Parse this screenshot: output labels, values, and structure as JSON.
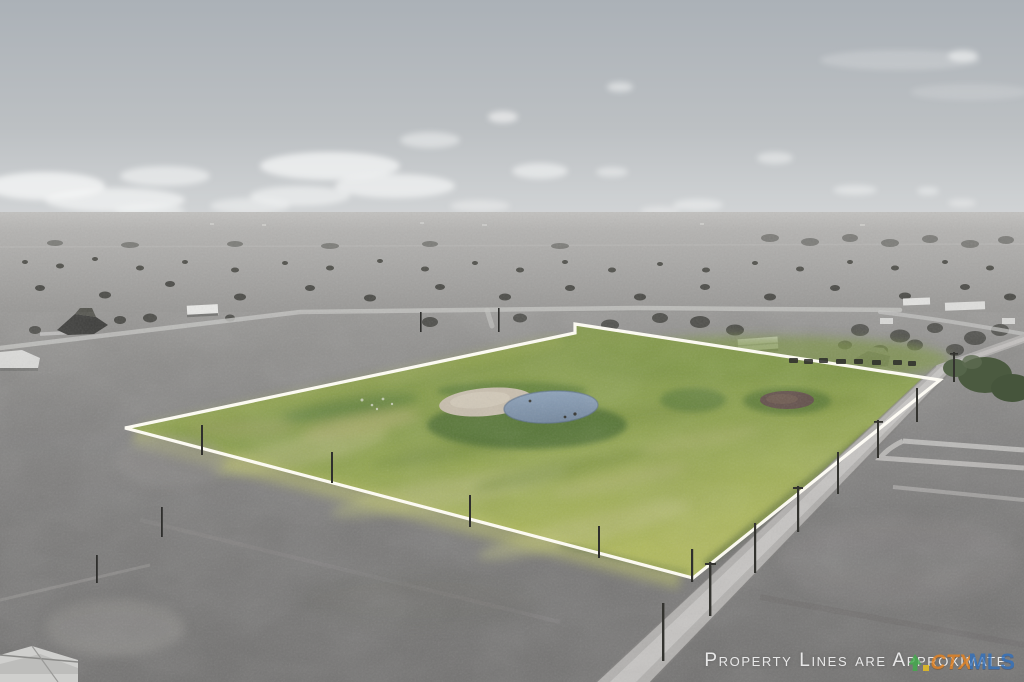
{
  "watermark": {
    "text": "Property Lines are Approximate",
    "color": "#ffffff"
  },
  "logo": {
    "prefix": "CTX",
    "suffix": "MLS",
    "prefix_color": "#e8821c",
    "suffix_color": "#2e6fbe",
    "icon": "tree-icon",
    "icon_color": "#3fae49",
    "icon_accent_color": "#f0c419"
  },
  "palette": {
    "sky_top": "#aab0b6",
    "sky_bottom": "#cdd0d2",
    "clouds": "#f4f5f5",
    "distant_plain": "#b2b1af",
    "midground_field": "#9a9997",
    "foreground_field": "#7a7978",
    "parcel_green": "#8ba04d",
    "parcel_dry_grass": "#b6b97c",
    "parcel_bright_edge": "#bfc468",
    "pond_water": "#8399b2",
    "pond_sand": "#c9bfae",
    "pond_vegetation": "#4b6c2e",
    "dry_pond": "#63504b",
    "road": "#b2b0ae",
    "road_center": "#c8c6c4",
    "boundary_line": "#fffdf6",
    "tree": "#4c4c48"
  },
  "scene": {
    "type": "aerial-drone-photo",
    "elements": [
      "sky",
      "clouds",
      "horizon",
      "distant-plain",
      "tree-scatter",
      "farm-houses",
      "gravel-roads",
      "highlighted-parcel",
      "boundary-lines",
      "pond",
      "pond-sand-bank",
      "pond-vegetation",
      "dry-pond",
      "county-road",
      "utility-poles",
      "fence-posts",
      "driveway-tracks",
      "foreground-field",
      "corner-house-roof"
    ]
  }
}
